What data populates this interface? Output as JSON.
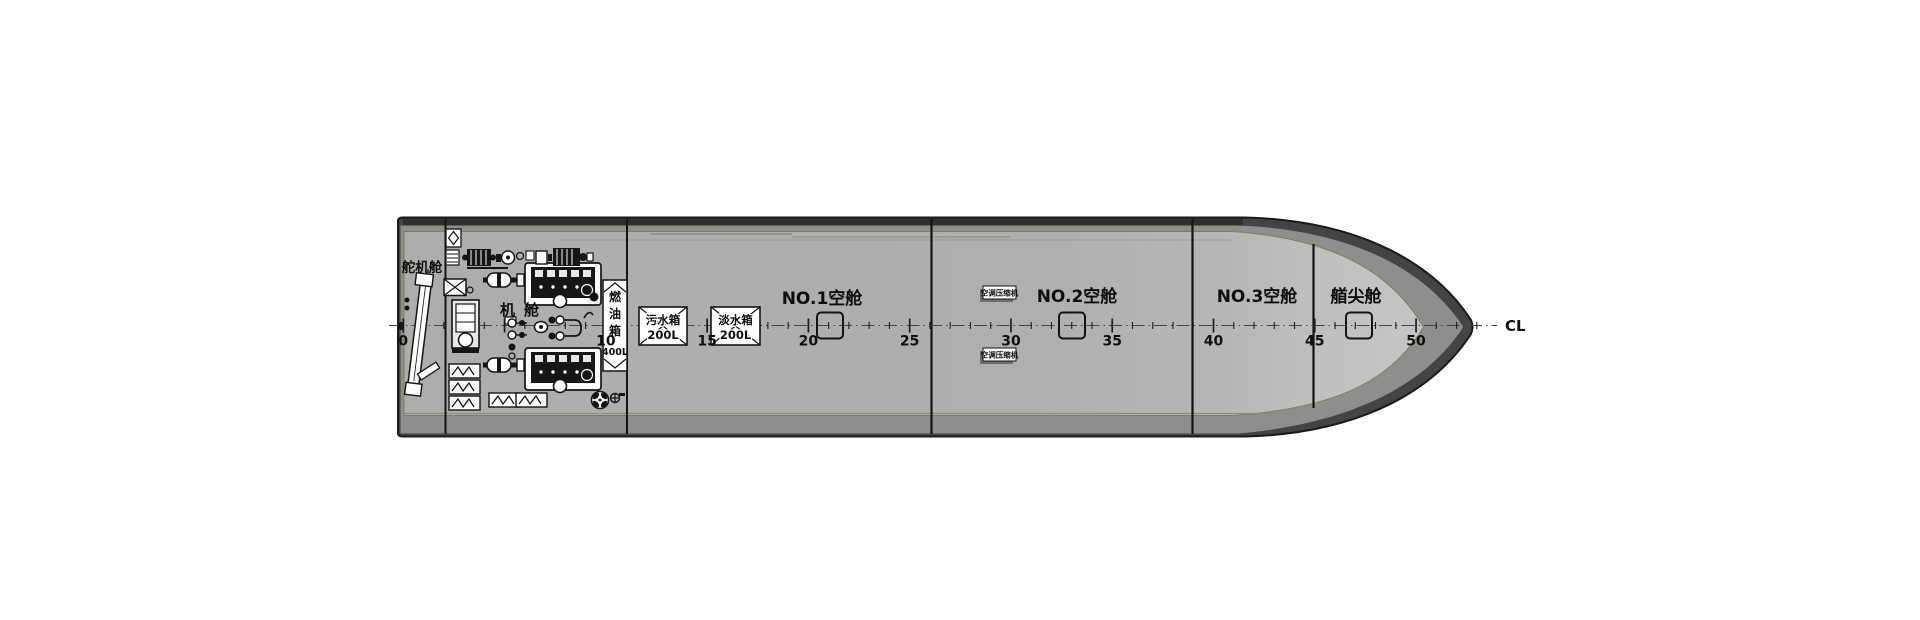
{
  "drawing": {
    "centerline_label": "CL",
    "compartments": {
      "steering_gear_room": "舵机舱",
      "engine_room": "机舱",
      "void_1": "NO.1空舱",
      "void_2": "NO.2空舱",
      "void_3": "NO.3空舱",
      "fore_peak": "艏尖舱"
    },
    "tanks": {
      "fuel_chars": [
        "燃",
        "油",
        "箱"
      ],
      "fuel_capacity": "400L",
      "sewage_name": "污水箱",
      "sewage_capacity": "200L",
      "fresh_name": "淡水箱",
      "fresh_capacity": "200L"
    },
    "equipment": {
      "ac_fwd": "空调压缩机",
      "ac_aft": "空调压缩机"
    },
    "frame_scale": {
      "labels": [
        "0",
        "10",
        "15",
        "20",
        "25",
        "30",
        "35",
        "40",
        "45",
        "50"
      ],
      "label_frames": [
        0,
        10,
        15,
        20,
        25,
        30,
        35,
        40,
        45,
        50
      ]
    },
    "colors": {
      "hull_outline": "#1a1a19",
      "hull_dark_band": "#454443",
      "hull_top_band": "#312f2e",
      "hull_mid_band": "#8f8e8c",
      "deck": "#b0afad",
      "deck_bow": "#c6c5c3",
      "background": "#ffffff"
    }
  }
}
